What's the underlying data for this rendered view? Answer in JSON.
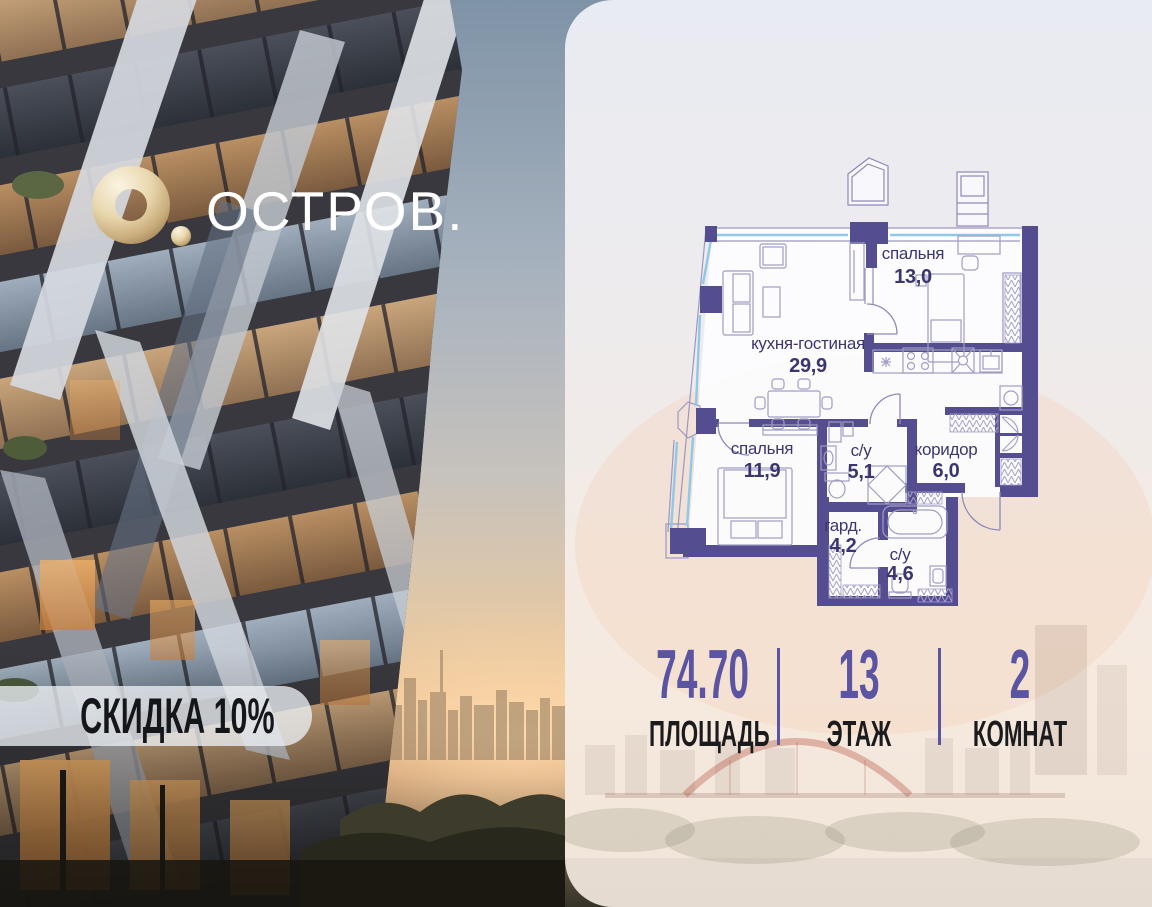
{
  "brand": {
    "logo_text": "ОСТРОВ.",
    "logo_o_icon": "gold-donut-with-dot",
    "discount_badge": "СКИДКА 10%"
  },
  "floorplan": {
    "rooms": [
      {
        "name": "спальня",
        "area": "13,0"
      },
      {
        "name": "кухня-гостиная",
        "area": "29,9"
      },
      {
        "name": "спальня",
        "area": "11,9"
      },
      {
        "name": "с/у",
        "area": "5,1"
      },
      {
        "name": "коридор",
        "area": "6,0"
      },
      {
        "name": "гард.",
        "area": "4,2"
      },
      {
        "name": "с/у",
        "area": "4,6"
      }
    ]
  },
  "stats": {
    "items": [
      {
        "value": "74.70",
        "label": "ПЛОЩАДЬ"
      },
      {
        "value": "13",
        "label": "ЭТАЖ"
      },
      {
        "value": "2",
        "label": "КОМНАТ"
      }
    ]
  },
  "colors": {
    "accent": "#5b54a2",
    "plan_wall": "#544e90",
    "plan_text": "#3b366e",
    "window_blue": "#8fc8e8",
    "logo_gold": "#d8c193",
    "badge_text": "#15161a"
  }
}
